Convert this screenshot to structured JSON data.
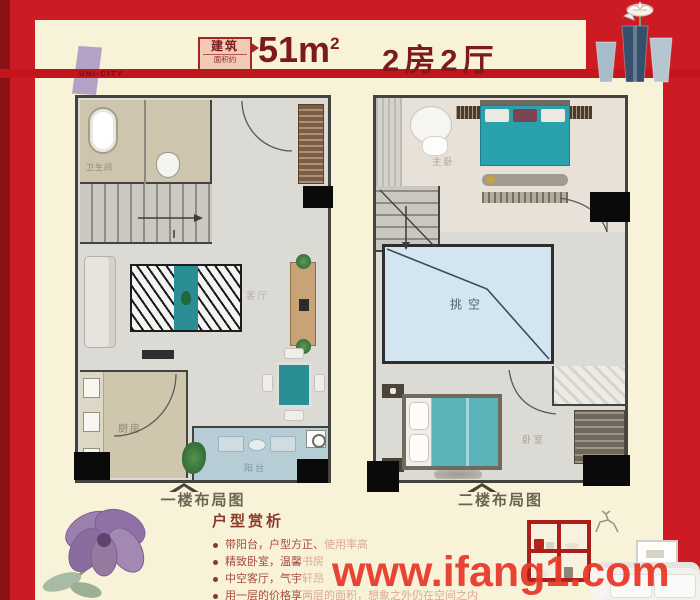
{
  "header": {
    "brand": "UNI-CITY",
    "stamp_line1": "建筑",
    "stamp_line2": "面积约",
    "area_value": "51m",
    "area_sup": "2",
    "layout_type": "2房2厅"
  },
  "plans": {
    "first_floor": {
      "caption": "一楼布局图",
      "rooms": {
        "bathroom": "卫生间",
        "living_room": "客厅",
        "kitchen": "厨房",
        "balcony": "阳台"
      }
    },
    "second_floor": {
      "caption": "二楼布局图",
      "rooms": {
        "master_bedroom": "主卧",
        "void": "挑空",
        "bedroom": "卧室"
      }
    }
  },
  "analysis": {
    "title": "户型赏析",
    "bullets": [
      {
        "strong": "带阳台，户型方正、",
        "faded": "使用率高"
      },
      {
        "strong": "精致卧室，温馨",
        "faded": "书房"
      },
      {
        "strong": "中空客厅，气宇",
        "faded": "轩昂"
      },
      {
        "strong": "用一层的价格享",
        "faded": "两层的面积，想象之外仍在空间之内"
      }
    ]
  },
  "watermark": "www.ifang1.com",
  "colors": {
    "background_red": "#cc1b22",
    "panel_cream": "#f8f2d9",
    "maroon_text": "#7c1a1f",
    "teal_furniture": "#2c8e95",
    "void_blue": "#d3e5f1",
    "watermark_red": "#e93a2b"
  }
}
